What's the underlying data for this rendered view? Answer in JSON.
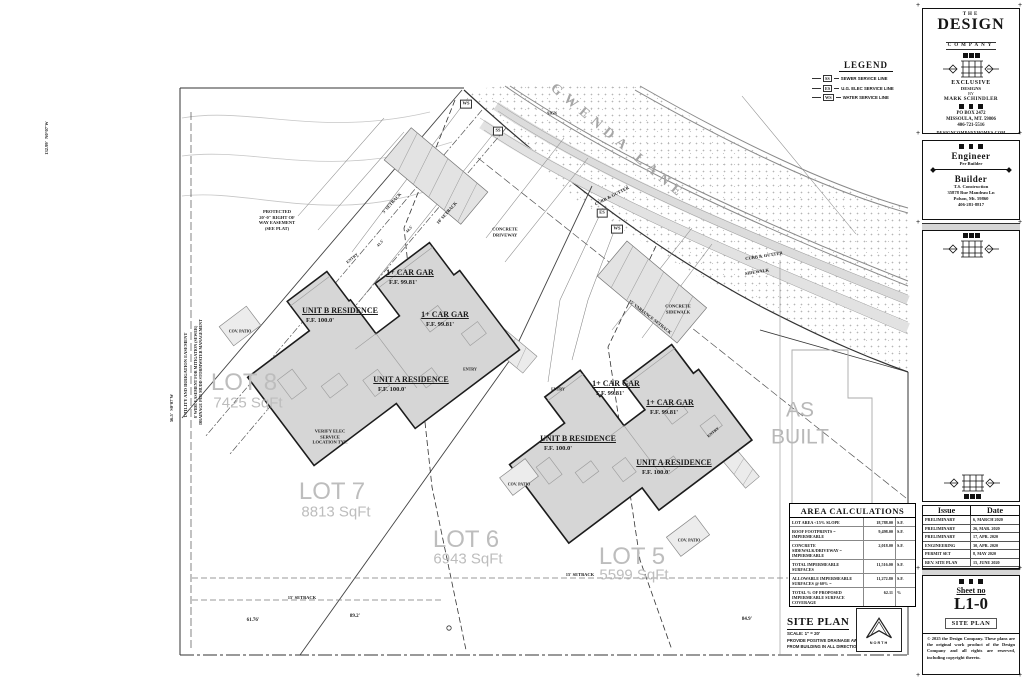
{
  "legend": {
    "title": "LEGEND",
    "items": [
      {
        "tag": "SS",
        "label": "SEWER SERVICE LINE"
      },
      {
        "tag": "ES",
        "label": "U.G. ELEC SERVICE LINE"
      },
      {
        "tag": "WS",
        "label": "WATER SERVICE LINE"
      }
    ]
  },
  "plan": {
    "labels": [
      {
        "name": "street-name-label",
        "text": "GWENDA LANE",
        "x": 618,
        "y": 142,
        "rot": 40,
        "size": 14,
        "color": "#a6a6a6",
        "ls": 6
      },
      {
        "name": "lot-8-label",
        "text": "LOT 8",
        "x": 244,
        "y": 383,
        "size": 24,
        "color": "#bdbdbd",
        "font": "sans"
      },
      {
        "name": "lot-8-area",
        "text": "7425 SqFt",
        "x": 248,
        "y": 404,
        "size": 15,
        "color": "#bdbdbd",
        "font": "sans"
      },
      {
        "name": "lot-7-label",
        "text": "LOT 7",
        "x": 332,
        "y": 492,
        "size": 24,
        "color": "#bdbdbd",
        "font": "sans"
      },
      {
        "name": "lot-7-area",
        "text": "8813 SqFt",
        "x": 336,
        "y": 513,
        "size": 15,
        "color": "#bdbdbd",
        "font": "sans"
      },
      {
        "name": "lot-6-label",
        "text": "LOT 6",
        "x": 466,
        "y": 540,
        "size": 24,
        "color": "#bdbdbd",
        "font": "sans"
      },
      {
        "name": "lot-6-area",
        "text": "6943 SqFt",
        "x": 468,
        "y": 560,
        "size": 15,
        "color": "#bdbdbd",
        "font": "sans"
      },
      {
        "name": "lot-5-label",
        "text": "LOT 5",
        "x": 632,
        "y": 557,
        "size": 24,
        "color": "#bdbdbd",
        "font": "sans"
      },
      {
        "name": "lot-5-area",
        "text": "5599 SqFt",
        "x": 634,
        "y": 576,
        "size": 15,
        "color": "#bdbdbd",
        "font": "sans"
      },
      {
        "name": "as-built-label",
        "text": "AS\nBUILT",
        "x": 800,
        "y": 424,
        "size": 21,
        "color": "#b8b8b8",
        "font": "sans",
        "lh": 1.3
      },
      {
        "name": "unit-b-left-label",
        "text": "UNIT B RESIDENCE",
        "x": 340,
        "y": 311,
        "size": 8,
        "underline": true
      },
      {
        "name": "unit-b-left-ff",
        "text": "F.F. 100.0'",
        "x": 320,
        "y": 321,
        "size": 6.5
      },
      {
        "name": "garage-1-left-label",
        "text": "1+ CAR GAR",
        "x": 410,
        "y": 273,
        "size": 8,
        "underline": true
      },
      {
        "name": "garage-1-left-ff",
        "text": "F.F. 99.81'",
        "x": 403,
        "y": 283,
        "size": 6.5
      },
      {
        "name": "garage-2-left-label",
        "text": "1+ CAR GAR",
        "x": 445,
        "y": 315,
        "size": 8,
        "underline": true
      },
      {
        "name": "garage-2-left-ff",
        "text": "F.F. 99.81'",
        "x": 440,
        "y": 325,
        "size": 6.5
      },
      {
        "name": "unit-a-left-label",
        "text": "UNIT A RESIDENCE",
        "x": 411,
        "y": 380,
        "size": 8,
        "underline": true
      },
      {
        "name": "unit-a-left-ff",
        "text": "F.F. 100.0'",
        "x": 392,
        "y": 390,
        "size": 6.5
      },
      {
        "name": "garage-1-right-label",
        "text": "1+ CAR GAR",
        "x": 616,
        "y": 384,
        "size": 8,
        "underline": true
      },
      {
        "name": "garage-1-right-ff",
        "text": "F.F. 99.81'",
        "x": 610,
        "y": 394,
        "size": 6.5
      },
      {
        "name": "garage-2-right-label",
        "text": "1+ CAR GAR",
        "x": 670,
        "y": 403,
        "size": 8,
        "underline": true
      },
      {
        "name": "garage-2-right-ff",
        "text": "F.F. 99.81'",
        "x": 664,
        "y": 413,
        "size": 6.5
      },
      {
        "name": "unit-b-right-label",
        "text": "UNIT B RESIDENCE",
        "x": 578,
        "y": 439,
        "size": 8,
        "underline": true
      },
      {
        "name": "unit-b-right-ff",
        "text": "F.F. 100.0'",
        "x": 558,
        "y": 449,
        "size": 6.5
      },
      {
        "name": "unit-a-right-label",
        "text": "UNIT A RESIDENCE",
        "x": 674,
        "y": 463,
        "size": 8,
        "underline": true
      },
      {
        "name": "unit-a-right-ff",
        "text": "F.F. 100.0'",
        "x": 656,
        "y": 473,
        "size": 6.5
      },
      {
        "name": "entry-label-1",
        "text": "ENTRY",
        "x": 352,
        "y": 258,
        "size": 4,
        "rot": -40
      },
      {
        "name": "entry-label-2",
        "text": "ENTRY",
        "x": 470,
        "y": 369,
        "size": 4
      },
      {
        "name": "entry-label-3",
        "text": "ENTRY",
        "x": 558,
        "y": 389,
        "size": 4
      },
      {
        "name": "entry-label-4",
        "text": "ENTRY",
        "x": 713,
        "y": 432,
        "size": 4,
        "rot": -40
      },
      {
        "name": "curb-gutter-label-1",
        "text": "CURB & GUTTER",
        "x": 612,
        "y": 196,
        "size": 4.5,
        "rot": -27
      },
      {
        "name": "curb-gutter-label-2",
        "text": "CURB & GUTTER",
        "x": 764,
        "y": 256,
        "size": 4.5,
        "rot": -9
      },
      {
        "name": "sidewalk-label",
        "text": "SIDEWALK",
        "x": 757,
        "y": 272,
        "size": 4.5,
        "rot": -9
      },
      {
        "name": "concrete-driveway-label",
        "text": "CONCRETE\nDRIVEWAY",
        "x": 505,
        "y": 232,
        "size": 4.5
      },
      {
        "name": "concrete-sidewalk-label",
        "text": "CONCRETE\nSIDEWALK",
        "x": 678,
        "y": 309,
        "size": 4.5
      },
      {
        "name": "verify-elec-note",
        "text": "VERIFY ELEC\nSERVICE\nLOCATION TYP.",
        "x": 330,
        "y": 437,
        "size": 4.5
      },
      {
        "name": "right-of-way-note",
        "text": "PROTECTED\n20'-0\" RIGHT OF\nWAY EASEMENT\n(SEE PLAT)",
        "x": 277,
        "y": 220,
        "size": 4.5
      },
      {
        "name": "setback-5-label",
        "text": "5' SETBACK",
        "x": 392,
        "y": 203,
        "size": 4.5,
        "rot": -48
      },
      {
        "name": "setback-10-label",
        "text": "10' SETBACK",
        "x": 447,
        "y": 213,
        "size": 4.5,
        "rot": -48
      },
      {
        "name": "variance-setback-label",
        "text": "15' VARIANCE SETBACK",
        "x": 650,
        "y": 317,
        "size": 4.5,
        "rot": 38
      },
      {
        "name": "setback-15-label-1",
        "text": "15' SETBACK",
        "x": 580,
        "y": 575,
        "size": 4.5
      },
      {
        "name": "setback-15-label-2",
        "text": "15' SETBACK",
        "x": 302,
        "y": 598,
        "size": 4.5
      },
      {
        "name": "dim-61-76",
        "text": "61.76'",
        "x": 253,
        "y": 621,
        "size": 5
      },
      {
        "name": "dim-89-2",
        "text": "89.2'",
        "x": 355,
        "y": 617,
        "size": 5
      },
      {
        "name": "dim-84-9",
        "text": "84.9'",
        "x": 747,
        "y": 620,
        "size": 5
      },
      {
        "name": "cov-patio-label-1",
        "text": "COV. PATIO",
        "x": 240,
        "y": 331,
        "size": 4
      },
      {
        "name": "cov-patio-label-2",
        "text": "COV. PATIO",
        "x": 519,
        "y": 484,
        "size": 4
      },
      {
        "name": "cov-patio-label-3",
        "text": "COV. PATIO",
        "x": 689,
        "y": 540,
        "size": 4
      },
      {
        "name": "easement-note-1",
        "text": "UTILITY AND IRRIGATION EASEMENT",
        "x": 186,
        "y": 375,
        "size": 4.5,
        "rot": -90
      },
      {
        "name": "easement-note-2",
        "text": "8' WIDE EASEMENT FOR MITIGATION (SEWER)\nDRAINAGE PER MUDD STORMWATER MANAGEMENT",
        "x": 198,
        "y": 372,
        "size": 4,
        "rot": -90
      },
      {
        "name": "dim-56-5",
        "text": "56.5'  S0°07'W",
        "x": 172,
        "y": 408,
        "size": 4.5,
        "rot": -90
      },
      {
        "name": "dim-132-99",
        "text": "132.99'  N0°07'W",
        "x": 47,
        "y": 138,
        "size": 4.5,
        "rot": -90
      },
      {
        "name": "sign-label",
        "text": "SIGN",
        "x": 552,
        "y": 113,
        "size": 4
      },
      {
        "name": "marker-ws-1",
        "text": "WS",
        "x": 466,
        "y": 104,
        "size": 4.5,
        "boxed": true
      },
      {
        "name": "marker-ss",
        "text": "SS",
        "x": 498,
        "y": 131,
        "size": 4.5,
        "boxed": true
      },
      {
        "name": "marker-es",
        "text": "ES",
        "x": 602,
        "y": 213,
        "size": 4.5,
        "boxed": true
      },
      {
        "name": "marker-ws-2",
        "text": "WS",
        "x": 617,
        "y": 229,
        "size": 4.5,
        "boxed": true
      },
      {
        "name": "dim-44-5",
        "text": "44.5'",
        "x": 409,
        "y": 229,
        "size": 4,
        "rot": -48
      },
      {
        "name": "dim-41-5",
        "text": "41.5'",
        "x": 380,
        "y": 243,
        "size": 4,
        "rot": -48
      }
    ]
  },
  "area_table": {
    "title": "AREA CALCULATIONS",
    "rows": [
      {
        "label": "LOT AREA <15% SLOPE",
        "value": "18,788.00",
        "unit": "S.F."
      },
      {
        "label": "ROOF FOOTPRINTS = IMPERMEABLE",
        "value": "9,498.00",
        "unit": "S.F."
      },
      {
        "label": "CONCRETE SIDEWALK/DRIVEWAY = IMPERMEABLE",
        "value": "2,018.00",
        "unit": "S.F."
      },
      {
        "label": "TOTAL IMPERMEABLE SURFACES",
        "value": "11,516.00",
        "unit": "S.F."
      },
      {
        "label": "ALLOWABLE IMPERMEABLE SURFACES @ 60% =",
        "value": "11,272.80",
        "unit": "S.F."
      },
      {
        "label": "TOTAL % OF PROPOSED IMPERMEABLE SURFACE COVERAGE",
        "value": "62.11",
        "unit": "%"
      }
    ]
  },
  "site_title": {
    "title": "SITE PLAN",
    "scale": "SCALE: 1\" = 20'",
    "note": "PROVIDE POSITIVE DRAINAGE AWAY\nFROM BUILDING IN ALL DIRECTIONS",
    "north_label": "NORTH"
  },
  "titleblock": {
    "firm": {
      "the": "THE",
      "design": "DESIGN",
      "company": "COMPANY",
      "tagline1": "EXCLUSIVE",
      "tagline2": "DESIGNS",
      "tagline3": "BY",
      "tagline4": "MARK SCHINDLER",
      "addr1": "PO BOX 2472",
      "addr2": "MISSOULA, MT. 59806",
      "phone": "406-721-5516",
      "web": "DESIGNCOMPANYHOMES.COM"
    },
    "engineer": {
      "heading": "Engineer",
      "note": "Per Builder"
    },
    "builder": {
      "heading": "Builder",
      "line1": "T.S. Construction",
      "line2": "35878 Rue Mandeau Ln",
      "line3": "Polson, Mt. 59860",
      "line4": "406-281-8817"
    },
    "project": {
      "rows": [
        {
          "label": "Project:",
          "value": "NEW CUSTOM HOMES, THE:"
        },
        {
          "label": "Owner:",
          "value": "GWENDA LANE LOTS 5 THRU 8 RES."
        },
        {
          "label": "Location:",
          "value": "GWENDA LANE, POLSON, MT. 59860"
        },
        {
          "label": "Legal:",
          "value": "LOT 7-8, VICWOOD SUBDIVISION, POLSON, MT."
        }
      ]
    },
    "issue_table": {
      "col1": "Issue",
      "col2": "Date",
      "rows": [
        {
          "issue": "PRELIMINARY",
          "date": "6, MARCH 2020"
        },
        {
          "issue": "PRELIMINARY",
          "date": "26, MAR. 2020"
        },
        {
          "issue": "PRELIMINARY",
          "date": "17, APR. 2020"
        },
        {
          "issue": "ENGINEERING",
          "date": "30, APR. 2020"
        },
        {
          "issue": "PERMIT SET",
          "date": "8, MAY 2020"
        },
        {
          "issue": "REV. SITE PLAN",
          "date": "15, JUNE 2020"
        }
      ]
    },
    "sheet": {
      "label": "Sheet no",
      "number": "L1-0",
      "name": "SITE PLAN",
      "copyright": "© 2025 the Design Company. These plans are the original work product of the Design Company and all rights are reserved, including copyright thereto."
    }
  }
}
